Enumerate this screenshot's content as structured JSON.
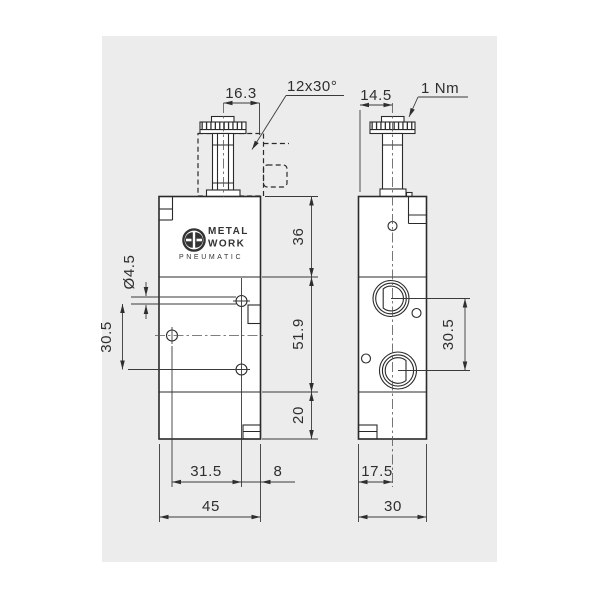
{
  "canvas": {
    "background": "#ececec",
    "page_background": "#ffffff",
    "line_color": "#2e2e2e"
  },
  "logo": {
    "metal": "METAL",
    "work": "WORK",
    "pneumatic": "PNEUMATIC"
  },
  "labels": {
    "chamfer": "12x30°",
    "torque": "1 Nm"
  },
  "front": {
    "dims": {
      "stem": "16.3",
      "hole_dia": "Ø4.5",
      "pitch_v": "30.5",
      "sec_top": "36",
      "sec_mid": "51.9",
      "sec_bot": "20",
      "pitch_h": "31.5",
      "edge": "8",
      "width": "45"
    }
  },
  "side": {
    "dims": {
      "stem": "14.5",
      "pitch": "30.5",
      "port": "17.5",
      "width": "30"
    }
  }
}
